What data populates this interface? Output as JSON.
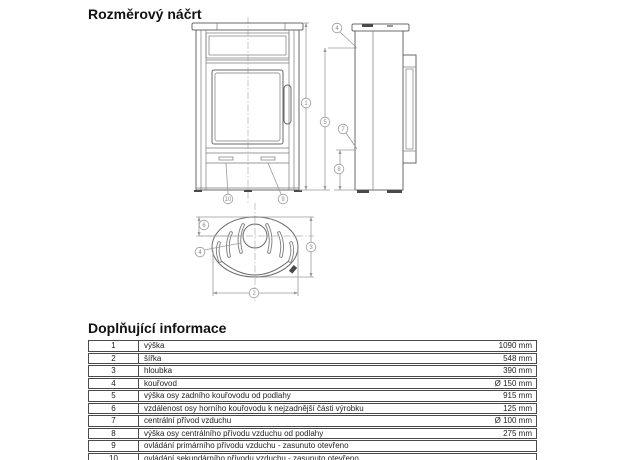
{
  "sections": {
    "drawing_title": "Rozměrový náčrt",
    "info_title": "Doplňující informace"
  },
  "drawing": {
    "views": [
      "front",
      "side",
      "top"
    ],
    "callouts": {
      "c1": "1",
      "c2": "2",
      "c3": "3",
      "c4": "4",
      "c5": "5",
      "c6": "6",
      "c7": "7",
      "c8": "8",
      "c9": "9",
      "c10": "10"
    },
    "line_color": "#6a6a6a",
    "dimension_color": "#9a9a9a"
  },
  "info_table": {
    "rows": [
      {
        "num": "1",
        "label": "výška",
        "value": "1090 mm"
      },
      {
        "num": "2",
        "label": "šířka",
        "value": "548 mm"
      },
      {
        "num": "3",
        "label": "hloubka",
        "value": "390 mm"
      },
      {
        "num": "4",
        "label": "kouřovod",
        "value": "Ø 150 mm"
      },
      {
        "num": "5",
        "label": "výška osy zadního kouřovodu od podlahy",
        "value": "915 mm"
      },
      {
        "num": "6",
        "label": "vzdálenost osy horního kouřovodu k nejzadnější části výrobku",
        "value": "125 mm"
      },
      {
        "num": "7",
        "label": "centrální přívod vzduchu",
        "value": "Ø 100 mm"
      },
      {
        "num": "8",
        "label": "výška osy centrálního přívodu vzduchu od podlahy",
        "value": "275 mm"
      },
      {
        "num": "9",
        "label": "ovládání primárního přívodu vzduchu - zasunuto otevřeno",
        "value": ""
      },
      {
        "num": "10",
        "label": "ovládání sekundárního přívodu vzduchu - zasunuto otevřeno",
        "value": ""
      }
    ]
  }
}
